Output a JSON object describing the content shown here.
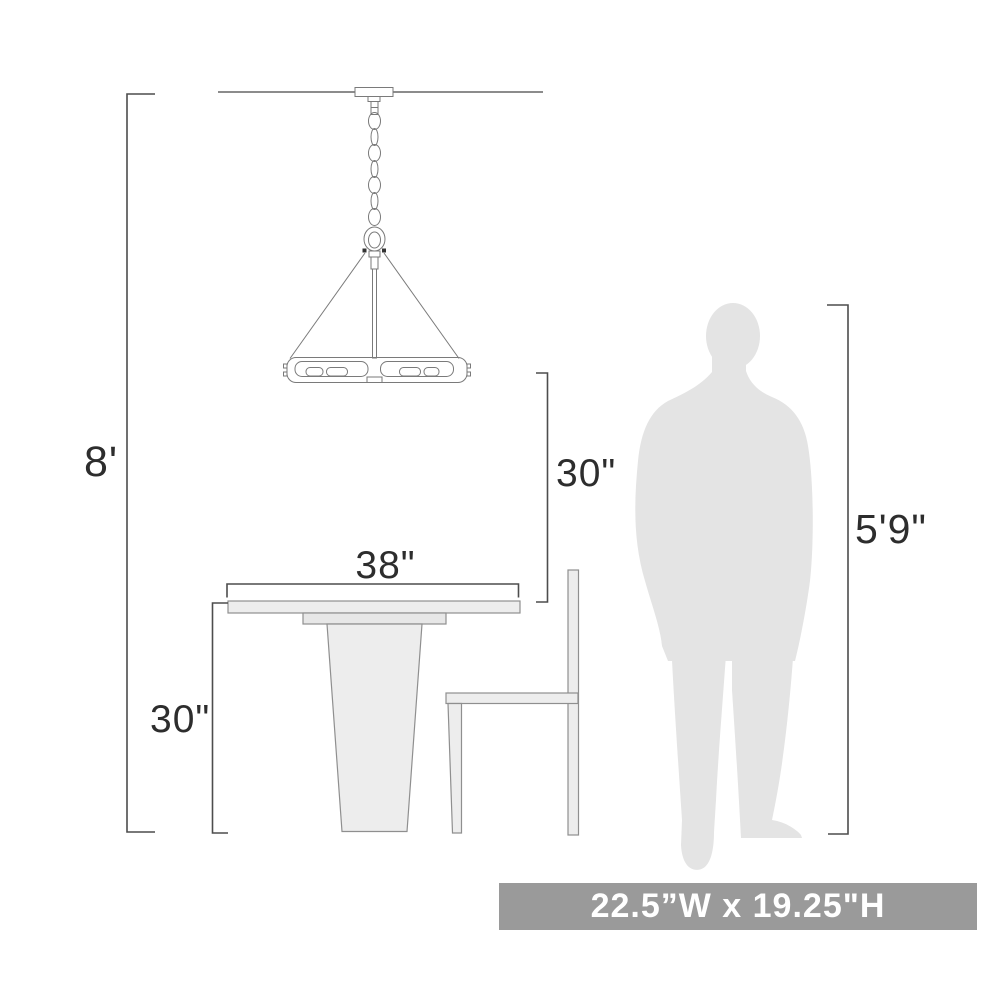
{
  "diagram": {
    "type": "product-scale-diagram",
    "depicts": [
      "pendant-light-fixture",
      "pedestal-dining-table",
      "dining-chair",
      "human-silhouette"
    ],
    "labels": {
      "ceiling_height": "8'",
      "pendant_to_table_clearance": "30\"",
      "table_width": "38\"",
      "table_height": "30\"",
      "person_height": "5'9\""
    },
    "banner": {
      "text": "22.5”W x 19.25\"H",
      "meaning": "fixture width and height",
      "bg_color": "#9a9a9a",
      "text_color": "#ffffff"
    },
    "colors": {
      "background": "#ffffff",
      "dimension_lines": "#4d4d4d",
      "label_text": "#2d2d2d",
      "fixture_outline": "#7a7a7a",
      "ceiling_line": "#8c8c8c",
      "furniture_fill": "#ededed",
      "furniture_stroke": "#8f8f8f",
      "person_fill": "#e4e4e4"
    }
  }
}
